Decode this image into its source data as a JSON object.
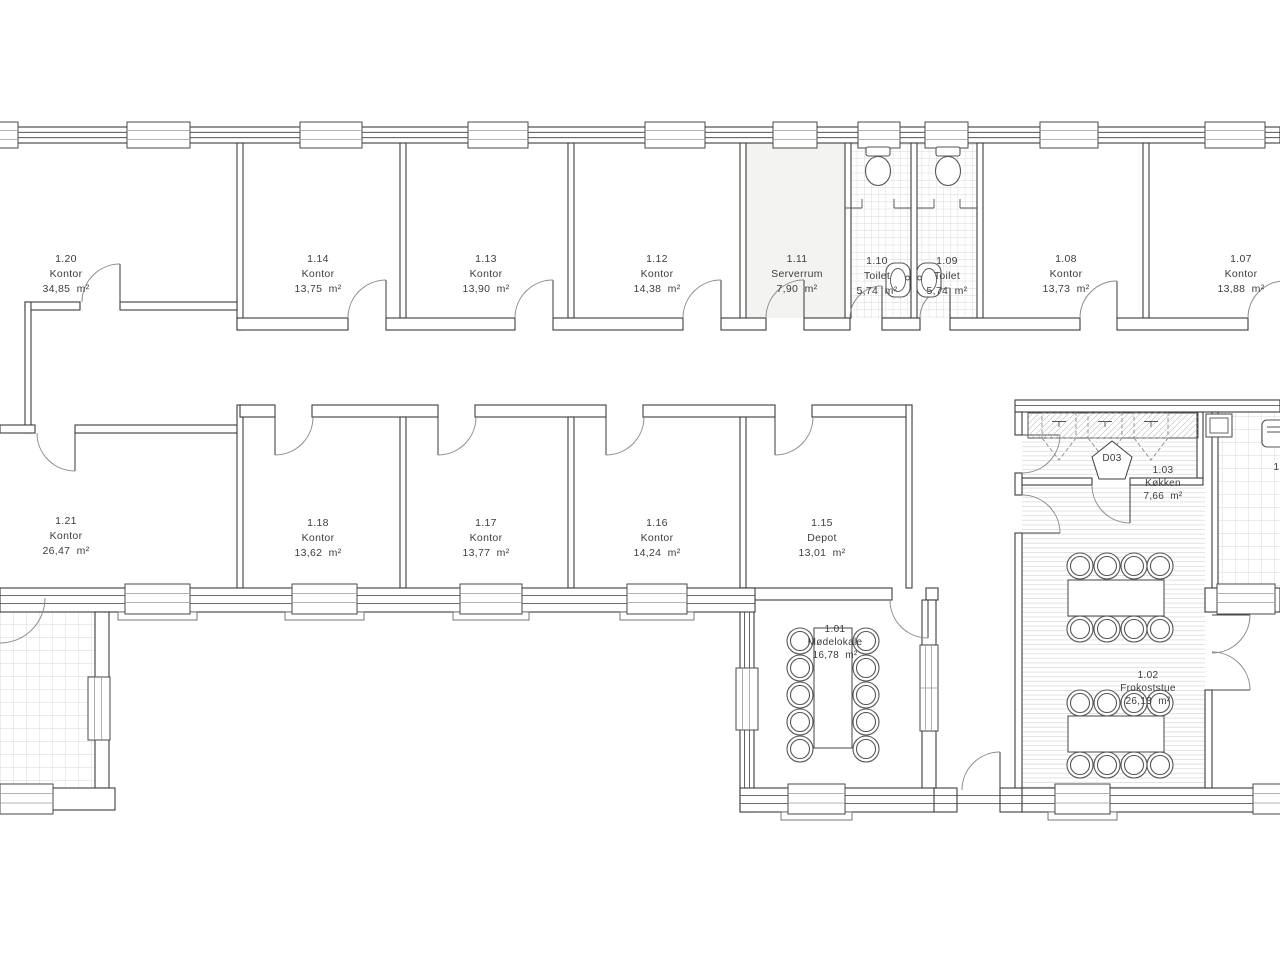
{
  "rooms": [
    {
      "id": "1.20",
      "name": "Kontor",
      "area": "34,85  m²"
    },
    {
      "id": "1.14",
      "name": "Kontor",
      "area": "13,75  m²"
    },
    {
      "id": "1.13",
      "name": "Kontor",
      "area": "13,90  m²"
    },
    {
      "id": "1.12",
      "name": "Kontor",
      "area": "14,38  m²"
    },
    {
      "id": "1.11",
      "name": "Serverrum",
      "area": "7,90  m²"
    },
    {
      "id": "1.10",
      "name": "Toilet",
      "area": "5,74  m²"
    },
    {
      "id": "1.09",
      "name": "Toilet",
      "area": "5,74  m²"
    },
    {
      "id": "1.08",
      "name": "Kontor",
      "area": "13,73  m²"
    },
    {
      "id": "1.07",
      "name": "Kontor",
      "area": "13,88  m²"
    },
    {
      "id": "1.21",
      "name": "Kontor",
      "area": "26,47  m²"
    },
    {
      "id": "1.18",
      "name": "Kontor",
      "area": "13,62  m²"
    },
    {
      "id": "1.17",
      "name": "Kontor",
      "area": "13,77  m²"
    },
    {
      "id": "1.16",
      "name": "Kontor",
      "area": "14,24  m²"
    },
    {
      "id": "1.15",
      "name": "Depot",
      "area": "13,01  m²"
    },
    {
      "id": "1.01",
      "name": "Mødelokale",
      "area": "16,78  m²"
    },
    {
      "id": "1.03",
      "name": "Køkken",
      "area": "7,66  m²"
    },
    {
      "id": "1.02",
      "name": "Frokoststue",
      "area": "26,13  m²"
    }
  ],
  "door_tag": "D03",
  "partial_room_label": "1.",
  "colors": {
    "line": "#3c3c3c",
    "tile": "#cccccc",
    "stripe": "#dcdcdc",
    "server_fill": "#f3f3f1"
  }
}
